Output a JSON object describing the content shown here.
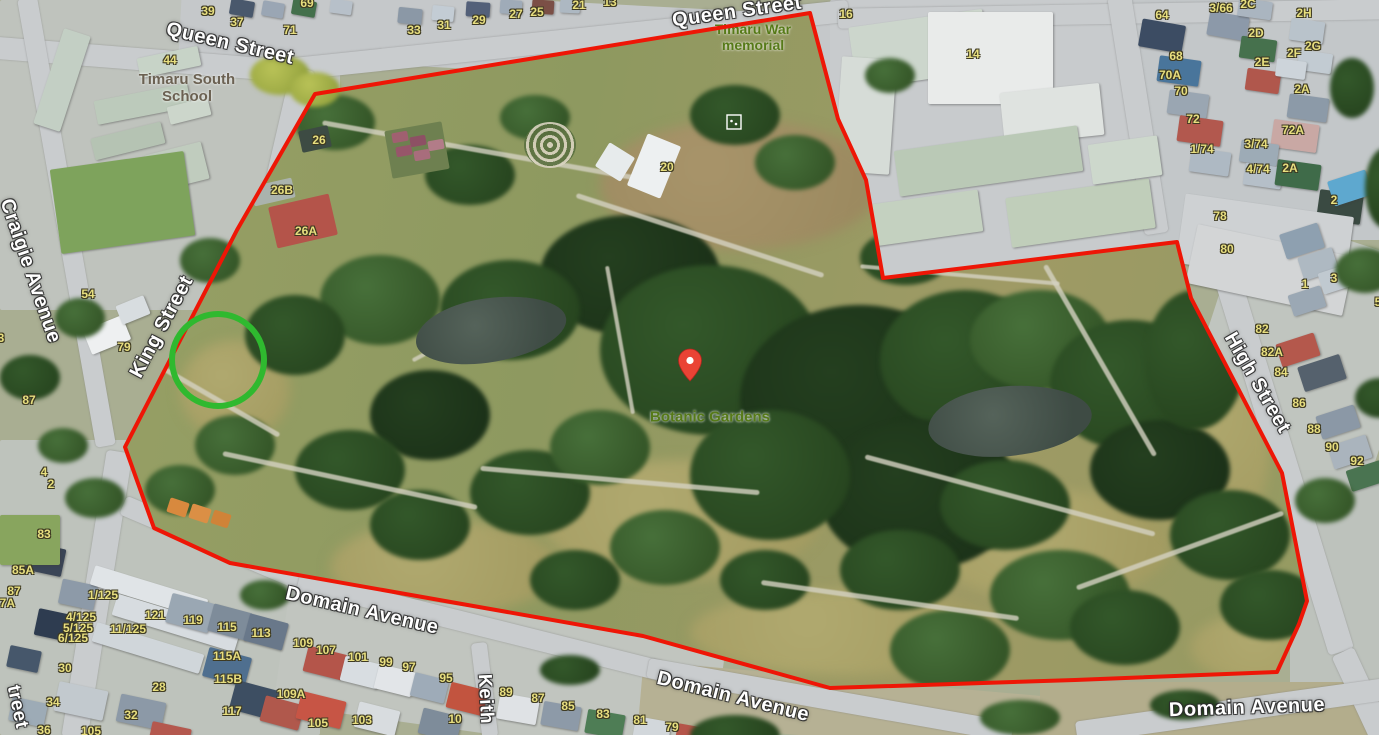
{
  "map_overlay": {
    "boundary": {
      "description": "red property boundary of Timaru Botanic Gardens",
      "color": "#ee1606",
      "stroke_width": 4,
      "points": "315,94 810,13 838,119 866,180 883,278 1177,242 1191,298 1282,473 1307,601 1299,624 1277,672 1075,680 830,688 643,636 230,563 154,528 125,447 237,230"
    },
    "highlight_circle": {
      "color": "#2fb92f",
      "cx": 218,
      "cy": 360,
      "r": 46,
      "stroke_width": 6
    },
    "marker_pin": {
      "color": "#ea4335",
      "dot_color": "#ffffff",
      "tip_x": 690,
      "tip_y": 381
    },
    "memorial_marker": {
      "x": 727,
      "y": 115,
      "size": 14,
      "color": "#ffffff"
    }
  },
  "street_labels": [
    {
      "text": "Queen Street",
      "x": 230,
      "y": 44,
      "rotate": 13,
      "size": 20
    },
    {
      "text": "Queen Street",
      "x": 737,
      "y": 12,
      "rotate": -8,
      "size": 20
    },
    {
      "text": "Craigie Avenue",
      "x": 30,
      "y": 271,
      "rotate": 71,
      "size": 20
    },
    {
      "text": "King Street",
      "x": 162,
      "y": 327,
      "rotate": -62,
      "size": 20
    },
    {
      "text": "High Street",
      "x": 1257,
      "y": 383,
      "rotate": 60,
      "size": 20
    },
    {
      "text": "Domain Avenue",
      "x": 362,
      "y": 611,
      "rotate": 13,
      "size": 20
    },
    {
      "text": "Domain Avenue",
      "x": 733,
      "y": 697,
      "rotate": 14,
      "size": 20
    },
    {
      "text": "Domain Avenue",
      "x": 1247,
      "y": 708,
      "rotate": -2,
      "size": 20
    },
    {
      "text": "Keith",
      "x": 485,
      "y": 699,
      "rotate": 87,
      "size": 19
    },
    {
      "text": "treet",
      "x": 17,
      "y": 707,
      "rotate": 78,
      "size": 19
    }
  ],
  "poi_labels": [
    {
      "lines": [
        "Timaru South",
        "School"
      ],
      "x": 187,
      "y": 88,
      "color": "#6b6152",
      "size": 15
    },
    {
      "lines": [
        "Timaru War",
        "memorial"
      ],
      "x": 753,
      "y": 37,
      "color": "#567a18",
      "size": 14
    },
    {
      "lines": [
        "Botanic Gardens"
      ],
      "x": 710,
      "y": 417,
      "color": "#567a18",
      "size": 15
    }
  ],
  "house_numbers": [
    {
      "text": "39",
      "x": 208,
      "y": 11
    },
    {
      "text": "37",
      "x": 237,
      "y": 22
    },
    {
      "text": "69",
      "x": 307,
      "y": 3
    },
    {
      "text": "71",
      "x": 290,
      "y": 30
    },
    {
      "text": "33",
      "x": 414,
      "y": 30
    },
    {
      "text": "31",
      "x": 444,
      "y": 25
    },
    {
      "text": "29",
      "x": 479,
      "y": 20
    },
    {
      "text": "27",
      "x": 516,
      "y": 14
    },
    {
      "text": "25",
      "x": 537,
      "y": 12
    },
    {
      "text": "21",
      "x": 579,
      "y": 5
    },
    {
      "text": "13",
      "x": 610,
      "y": 2
    },
    {
      "text": "44",
      "x": 170,
      "y": 60
    },
    {
      "text": "26",
      "x": 319,
      "y": 140
    },
    {
      "text": "26B",
      "x": 282,
      "y": 190
    },
    {
      "text": "26A",
      "x": 306,
      "y": 231
    },
    {
      "text": "20",
      "x": 667,
      "y": 167
    },
    {
      "text": "16",
      "x": 846,
      "y": 14
    },
    {
      "text": "14",
      "x": 973,
      "y": 54
    },
    {
      "text": "64",
      "x": 1162,
      "y": 15
    },
    {
      "text": "3/66",
      "x": 1221,
      "y": 8
    },
    {
      "text": "2C",
      "x": 1248,
      "y": 4
    },
    {
      "text": "2H",
      "x": 1304,
      "y": 13
    },
    {
      "text": "2D",
      "x": 1256,
      "y": 33
    },
    {
      "text": "2G",
      "x": 1313,
      "y": 46
    },
    {
      "text": "2F",
      "x": 1294,
      "y": 53
    },
    {
      "text": "2E",
      "x": 1262,
      "y": 62
    },
    {
      "text": "68",
      "x": 1176,
      "y": 56
    },
    {
      "text": "70A",
      "x": 1170,
      "y": 75
    },
    {
      "text": "70",
      "x": 1181,
      "y": 91
    },
    {
      "text": "2A",
      "x": 1302,
      "y": 89
    },
    {
      "text": "72",
      "x": 1193,
      "y": 119
    },
    {
      "text": "72A",
      "x": 1293,
      "y": 130
    },
    {
      "text": "1/74",
      "x": 1202,
      "y": 149
    },
    {
      "text": "3/74",
      "x": 1256,
      "y": 144
    },
    {
      "text": "4/74",
      "x": 1258,
      "y": 169
    },
    {
      "text": "2A",
      "x": 1290,
      "y": 168
    },
    {
      "text": "2",
      "x": 1334,
      "y": 200
    },
    {
      "text": "78",
      "x": 1220,
      "y": 216
    },
    {
      "text": "80",
      "x": 1227,
      "y": 249
    },
    {
      "text": "1",
      "x": 1305,
      "y": 284
    },
    {
      "text": "3",
      "x": 1334,
      "y": 278
    },
    {
      "text": "5",
      "x": 1378,
      "y": 302
    },
    {
      "text": "82",
      "x": 1262,
      "y": 329
    },
    {
      "text": "82A",
      "x": 1272,
      "y": 352
    },
    {
      "text": "84",
      "x": 1281,
      "y": 372
    },
    {
      "text": "86",
      "x": 1299,
      "y": 403
    },
    {
      "text": "88",
      "x": 1314,
      "y": 429
    },
    {
      "text": "90",
      "x": 1332,
      "y": 447
    },
    {
      "text": "92",
      "x": 1357,
      "y": 461
    },
    {
      "text": "54",
      "x": 88,
      "y": 294
    },
    {
      "text": "79",
      "x": 124,
      "y": 347
    },
    {
      "text": "87",
      "x": 29,
      "y": 400
    },
    {
      "text": "3",
      "x": 1,
      "y": 338
    },
    {
      "text": "4",
      "x": 44,
      "y": 472
    },
    {
      "text": "2",
      "x": 51,
      "y": 484
    },
    {
      "text": "83",
      "x": 44,
      "y": 534
    },
    {
      "text": "85A",
      "x": 23,
      "y": 570
    },
    {
      "text": "87",
      "x": 14,
      "y": 591
    },
    {
      "text": "87A",
      "x": 4,
      "y": 603
    },
    {
      "text": "1/125",
      "x": 103,
      "y": 595
    },
    {
      "text": "4/125",
      "x": 81,
      "y": 617
    },
    {
      "text": "5/125",
      "x": 78,
      "y": 628
    },
    {
      "text": "11/125",
      "x": 128,
      "y": 629
    },
    {
      "text": "6/125",
      "x": 73,
      "y": 638
    },
    {
      "text": "121",
      "x": 155,
      "y": 615
    },
    {
      "text": "119",
      "x": 193,
      "y": 620
    },
    {
      "text": "115",
      "x": 227,
      "y": 627
    },
    {
      "text": "113",
      "x": 261,
      "y": 633
    },
    {
      "text": "115A",
      "x": 227,
      "y": 656
    },
    {
      "text": "115B",
      "x": 228,
      "y": 679
    },
    {
      "text": "117",
      "x": 232,
      "y": 711
    },
    {
      "text": "30",
      "x": 65,
      "y": 668
    },
    {
      "text": "28",
      "x": 159,
      "y": 687
    },
    {
      "text": "34",
      "x": 53,
      "y": 702
    },
    {
      "text": "32",
      "x": 131,
      "y": 715
    },
    {
      "text": "36",
      "x": 44,
      "y": 730
    },
    {
      "text": "105",
      "x": 91,
      "y": 731
    },
    {
      "text": "109A",
      "x": 291,
      "y": 694
    },
    {
      "text": "109",
      "x": 303,
      "y": 643
    },
    {
      "text": "107",
      "x": 326,
      "y": 650
    },
    {
      "text": "101",
      "x": 358,
      "y": 657
    },
    {
      "text": "99",
      "x": 386,
      "y": 662
    },
    {
      "text": "97",
      "x": 409,
      "y": 667
    },
    {
      "text": "95",
      "x": 446,
      "y": 678
    },
    {
      "text": "103",
      "x": 362,
      "y": 720
    },
    {
      "text": "105",
      "x": 318,
      "y": 723
    },
    {
      "text": "10",
      "x": 455,
      "y": 719
    },
    {
      "text": "89",
      "x": 506,
      "y": 692
    },
    {
      "text": "87",
      "x": 538,
      "y": 698
    },
    {
      "text": "85",
      "x": 568,
      "y": 706
    },
    {
      "text": "83",
      "x": 603,
      "y": 714
    },
    {
      "text": "81",
      "x": 640,
      "y": 720
    },
    {
      "text": "79",
      "x": 672,
      "y": 727
    }
  ]
}
